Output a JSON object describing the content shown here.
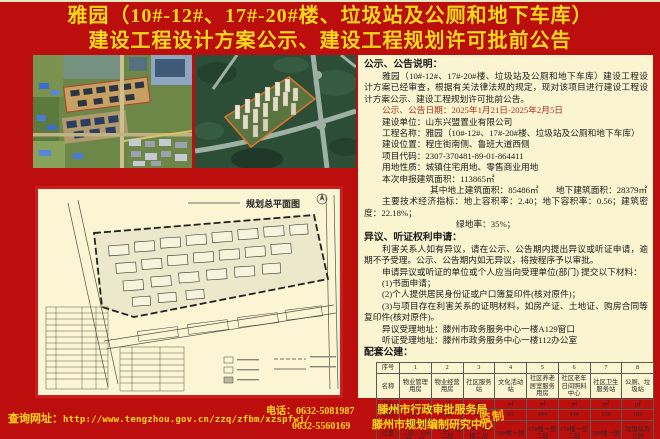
{
  "title": {
    "line1": "雅园（10#-12#、17#-20#楼、垃圾站及公厕和地下车库）",
    "line2": "建设工程设计方案公示、建设工程规划许可批前公告"
  },
  "site_plan": {
    "title": "规划总平面图"
  },
  "notice": {
    "heading": "公示、公告说明：",
    "intro": "雅园（10#-12#、17#-20#楼、垃圾站及公厕和地下车库）建设工程设计方案已经审查，根据有关法律法规的规定，现对该项目进行建设工程设计方案公示、建设工程规划许可批前公告。",
    "date_line": "公示、公告日期：2025年1月21日-2025年2月5日",
    "fields": [
      "建设单位：山东兴盟置业有限公司",
      "工程名称：雅园（10#-12#、17#-20#楼、垃圾站及公厕和地下车库）",
      "建设位置：程庄街南侧、鲁班大道西侧",
      "项目代码：2307-370481-89-01-864411",
      "用地性质：城镇住宅用地、零售商业用地",
      "本次申报建筑面积：113865㎡"
    ],
    "sub_area": "其中地上建筑面积：85486㎡　　地下建筑面积：28379㎡",
    "indicators": "主要技术经济指标：地上容积率：2.40；地下容积率：0.56；建筑密度：22.18%；",
    "green_rate": "绿地率：35%；"
  },
  "objection": {
    "heading": "异议、听证权利申请：",
    "para1": "利害关系人如有异议，请在公示、公告期内提出异议或听证申请，逾期不予受理。公示、公告期内如无异议，将按程序予以审批。",
    "para2": "申请异议或听证的单位或个人应当向受理单位(部门) 提交以下材料：",
    "items": [
      "(1)书面申请；",
      "(2)个人提供居民身份证或户口簿复印件(核对原件)；",
      "(3)与项目存在利害关系的证明材料，如房产证、土地证、购房合同等复印件(核对原件)。"
    ],
    "address1": "异议受理地址：滕州市政务服务中心一楼A129窗口",
    "address2": "听证受理地址：滕州市政务服务中心一楼112办公室"
  },
  "facilities": {
    "heading": "配套公建：",
    "row_labels": [
      "序号",
      "名称",
      "单位",
      "面积",
      "位置"
    ],
    "columns": [
      {
        "no": "1",
        "name": "物业管理用房",
        "unit": "㎡",
        "area": "609",
        "location": "17#楼一层二层、18#楼一层"
      },
      {
        "no": "2",
        "name": "物业经营用房",
        "unit": "㎡",
        "area": "406",
        "location": "17#楼一层二层"
      },
      {
        "no": "3",
        "name": "社区服务站",
        "unit": "㎡",
        "area": "507",
        "location": "17#、18#楼二层"
      },
      {
        "no": "4",
        "name": "文化活动站",
        "unit": "㎡",
        "area": "83",
        "location": "18#楼一层"
      },
      {
        "no": "5",
        "name": "社区养老居室服务用房",
        "unit": "㎡",
        "area": "444",
        "location": "17#楼一层二层"
      },
      {
        "no": "6",
        "name": "社区老年日间照料中心",
        "unit": "㎡",
        "area": "444",
        "location": "17#楼一层二层"
      },
      {
        "no": "7",
        "name": "社区卫生服务站",
        "unit": "㎡",
        "area": "158",
        "location": "18#楼一层"
      },
      {
        "no": "8",
        "name": "公厕、垃圾站",
        "unit": "㎡",
        "area": "183",
        "location": "垃圾站及公厕"
      }
    ]
  },
  "footer": {
    "url_label": "查询网址：",
    "url": "http://www.tengzhou.gov.cn/zzq/zfbm/xzspfwj/",
    "phone_label": "电话：",
    "phone1": "0632-5081987",
    "phone2": "0632-5560169",
    "agency1": "滕州市行政审批服务局",
    "agency2": "滕州市规划编制研究中心",
    "seal": "监制"
  },
  "colors": {
    "background_red": "#bd0e0e",
    "title_yellow": "#ffd818",
    "panel_cream": "#faf4d0",
    "plan_border_red": "#c81e1e"
  }
}
